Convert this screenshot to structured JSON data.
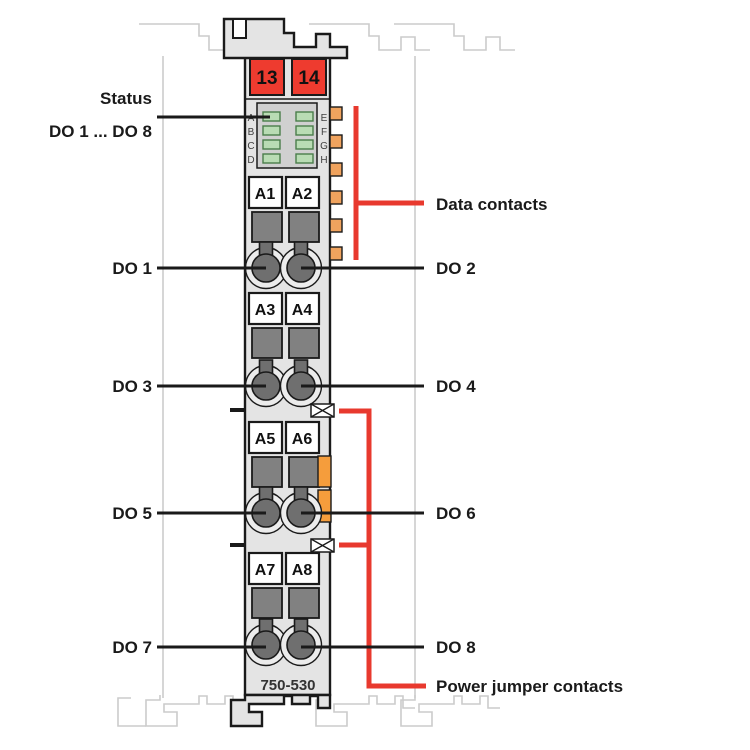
{
  "diagram": {
    "model": "750-530",
    "markers": [
      "13",
      "14"
    ],
    "led_letters": [
      "A",
      "B",
      "C",
      "D",
      "E",
      "F",
      "G",
      "H"
    ],
    "terminals": [
      "A1",
      "A2",
      "A3",
      "A4",
      "A5",
      "A6",
      "A7",
      "A8"
    ],
    "channels_left": [
      "DO 1",
      "DO 3",
      "DO 5",
      "DO 7"
    ],
    "channels_right": [
      "DO 2",
      "DO 4",
      "DO 6",
      "DO 8"
    ],
    "labels": {
      "status": "Status",
      "status_range": "DO 1 ... DO 8",
      "data_contacts": "Data contacts",
      "power_jumper": "Power jumper contacts"
    },
    "counts": {
      "status_leds": 8,
      "data_contacts": 6,
      "power_jumper_contacts": 2,
      "terminal_rows": 4
    },
    "colors": {
      "marker_red": "#ee3b2f",
      "callout_red": "#e8392e",
      "data_contact_orange": "#f0a35e",
      "power_contact_orange": "#f59d3c",
      "led_green": "#b9dcb4",
      "module_gray": "#e4e4e4",
      "outline_dark": "#1a1a1a",
      "neighbor_outline": "#cbcbcb"
    }
  }
}
